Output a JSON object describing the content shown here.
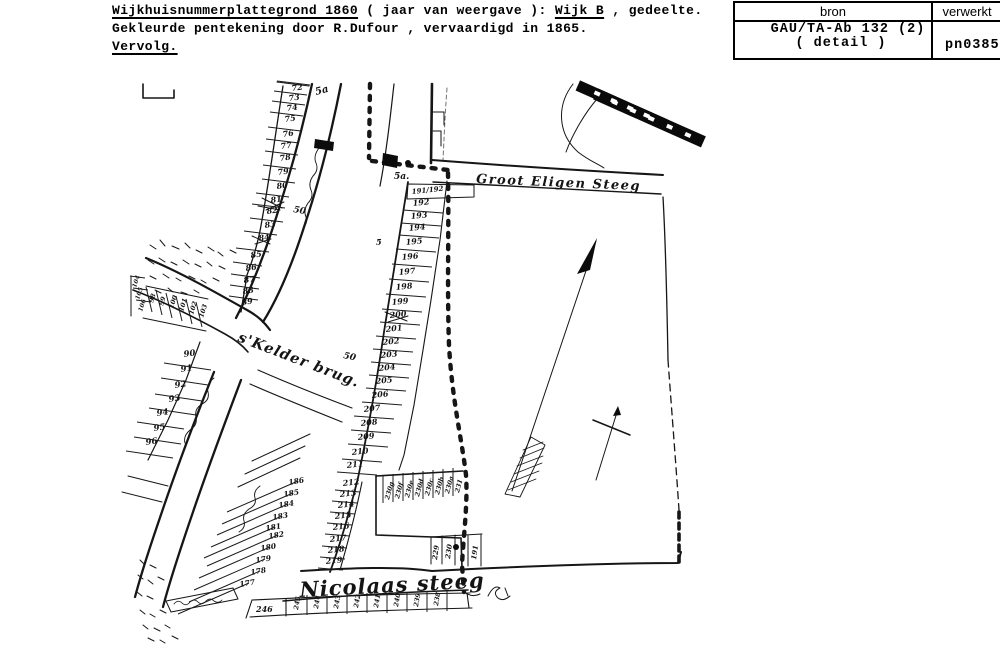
{
  "header": {
    "line1_u1": "Wijkhuisnummerplattegrond 1860",
    "line1_t1": " ( jaar van weergave ): ",
    "line1_u2": "Wijk B",
    "line1_t2": " , gedeelte.",
    "line2": "Gekleurde pentekening door R.Dufour , vervaardigd in 1865.",
    "line3_u": "Vervolg."
  },
  "source_table": {
    "col1_header": "bron",
    "col2_header": "verwerkt",
    "col1_value_line1": "GAU/TA-Ab 132 (2)",
    "col1_value_line2": "( detail )",
    "col2_value": "pn0385"
  },
  "map": {
    "labels": {
      "groot_eligen_steeg": "Groot Eligen Steeg",
      "nicolaas_steeg": "Nicolaas steeg",
      "kelder_brug": "s'Kelder brug.",
      "road_mark_5a_top": "5a",
      "road_mark_50_upper": "50",
      "road_mark_5a_mid": "5a.",
      "road_mark_5_mid": "5",
      "road_mark_50_lower": "50"
    },
    "parcels": {
      "left_top": [
        "72",
        "73",
        "74",
        "75",
        "76",
        "77",
        "78",
        "79",
        "80",
        "81",
        "82",
        "83",
        "84",
        "85"
      ],
      "left_mid": [
        "86",
        "87",
        "88",
        "89"
      ],
      "left_low": [
        "90",
        "91",
        "92",
        "93",
        "94",
        "95",
        "96"
      ],
      "left_rotated": [
        "98",
        "99",
        "100",
        "101",
        "102",
        "103"
      ],
      "left_edge": [
        "104",
        "105",
        "106"
      ],
      "main_column": [
        "191/192",
        "192",
        "193",
        "194",
        "195",
        "196",
        "197",
        "198",
        "199",
        "200",
        "201",
        "202",
        "203",
        "204",
        "205",
        "206",
        "207",
        "208",
        "209",
        "210",
        "211",
        "212",
        "213",
        "214",
        "215",
        "216",
        "217",
        "218",
        "219"
      ],
      "sub_row_230": [
        "230g",
        "230f",
        "230e",
        "230d",
        "230c",
        "230b",
        "230a",
        "231"
      ],
      "right_rotated": [
        "229",
        "230",
        "191"
      ],
      "diagonal": [
        "186",
        "185",
        "184",
        "183",
        "181",
        "182",
        "180",
        "179",
        "178",
        "177"
      ],
      "bottom_row_first": "246",
      "bottom_row": [
        "245",
        "244",
        "243",
        "242",
        "241",
        "240",
        "239",
        "238"
      ]
    }
  }
}
